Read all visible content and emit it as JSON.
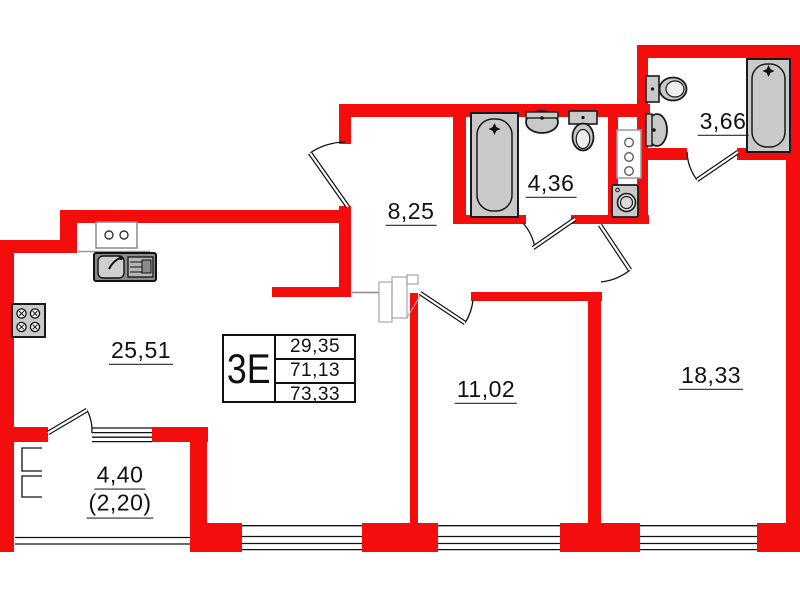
{
  "info": {
    "type_code": "3Е",
    "rows": [
      "29,35",
      "71,13",
      "73,33"
    ]
  },
  "rooms": {
    "kitchen_living": {
      "area": "25,51"
    },
    "hallway": {
      "area": "8,25"
    },
    "bathroom": {
      "area": "4,36"
    },
    "wc": {
      "area": "3,66"
    },
    "bedroom_1": {
      "area": "11,02"
    },
    "bedroom_2": {
      "area": "18,33"
    },
    "balcony": {
      "area": "4,40",
      "area_coeff": "(2,20)"
    }
  },
  "colors": {
    "wall": "#f30d0d",
    "fixture_fill": "#c9c9c9",
    "fixture_stroke": "#1a1a1a",
    "text": "#111111"
  },
  "fixtures": [
    "stove",
    "kitchen-sink",
    "electric-panel",
    "bathtub",
    "wash-basin",
    "toilet",
    "ventilation-shaft",
    "washing-machine",
    "wardrobe",
    "balcony-glazing"
  ]
}
